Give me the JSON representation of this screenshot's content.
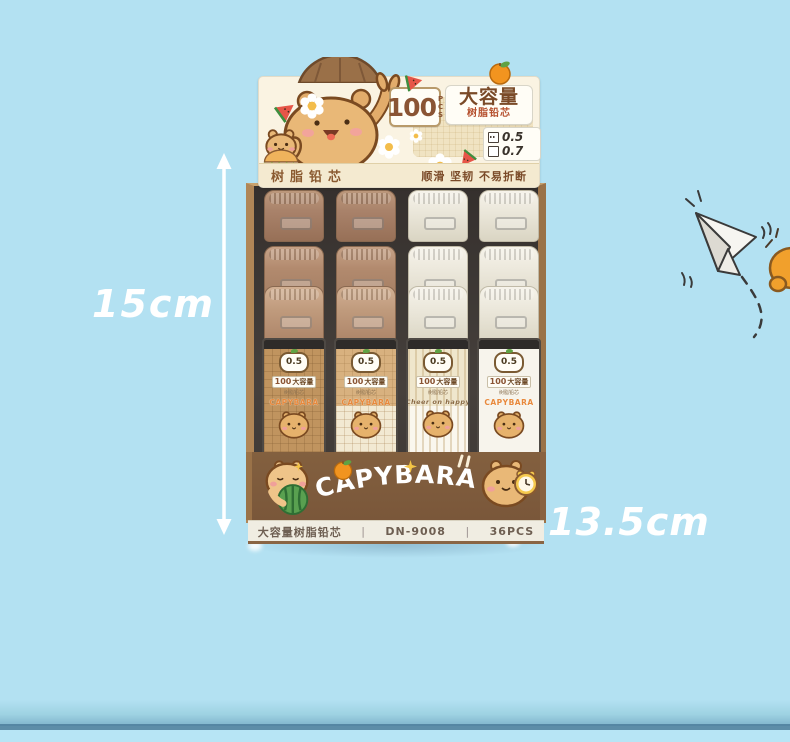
{
  "scene": {
    "height_label": "15cm",
    "width_label": "13.5cm"
  },
  "header_card": {
    "pcs_number": "100",
    "pcs_unit": "PCS",
    "title_large": "大容量",
    "title_sub": "树脂铅芯",
    "size_options": [
      {
        "label": "0.5",
        "checked": true
      },
      {
        "label": "0.7",
        "checked": false
      }
    ],
    "banner_left": "树脂铅芯",
    "banner_right": "顺滑 坚韧 不易折断"
  },
  "front_panel": {
    "brand": "CAPYBARA"
  },
  "bottom_strip": {
    "divider": "|",
    "items": [
      "大容量树脂铅芯",
      "DN-9008",
      "36PCS"
    ]
  },
  "containers": {
    "rows": 3,
    "columns": 4,
    "front_labels": [
      {
        "size_badge": "0.5",
        "count": "100",
        "title": "大容量",
        "subtitle": "树脂铅芯",
        "brand": "CAPYBARA"
      },
      {
        "size_badge": "0.5",
        "count": "100",
        "title": "大容量",
        "subtitle": "树脂铅芯",
        "brand": "CAPYBARA"
      },
      {
        "size_badge": "0.5",
        "count": "100",
        "title": "大容量",
        "subtitle": "树脂铅芯",
        "brand": "Cheer on happy"
      },
      {
        "size_badge": "0.5",
        "count": "100",
        "title": "大容量",
        "subtitle": "树脂铅芯",
        "brand": "CAPYBARA"
      }
    ]
  },
  "colors": {
    "background": "#B3E1F2",
    "box_brown": "#7A573A",
    "cardboard": "#A87F55",
    "header_cream": "#FAF3E2",
    "accent_orange": "#F2941F",
    "dimension_text": "#FFFFFF"
  }
}
